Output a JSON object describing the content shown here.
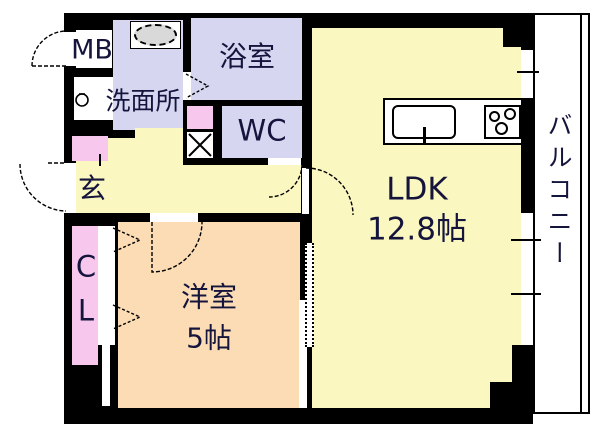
{
  "rooms": {
    "mb": {
      "label": "MB"
    },
    "senmenjo": {
      "label": "洗面所"
    },
    "yokushitsu": {
      "label": "浴室"
    },
    "wc": {
      "label": "WC"
    },
    "genkan": {
      "label": "玄"
    },
    "closet": {
      "line1": "C",
      "line2": "L"
    },
    "yoshitsu": {
      "label": "洋室",
      "size": "5帖"
    },
    "ldk": {
      "label": "LDK",
      "size": "12.8帖"
    },
    "balcony": {
      "label": "バルコニー"
    }
  },
  "colors": {
    "wall": "#000000",
    "room_yellow": "#faf7c0",
    "room_lavender": "#d6d6f0",
    "room_peach": "#fbdcb4",
    "accent_pink": "#f7c7ee",
    "fixture_gray": "#d9d9d9",
    "label_text": "#14143c"
  },
  "icons": {
    "wash-basin-icon": "gray oval basin",
    "faucet-icon": "small tap circle",
    "pipe-space-x-icon": "box with X",
    "kitchen-sink-icon": "rounded sink with tap stub",
    "stove-icon": "three burner circles",
    "door-swing-icon": "quarter-circle door arcs",
    "folding-door-icon": "dashed arrow triangles"
  }
}
